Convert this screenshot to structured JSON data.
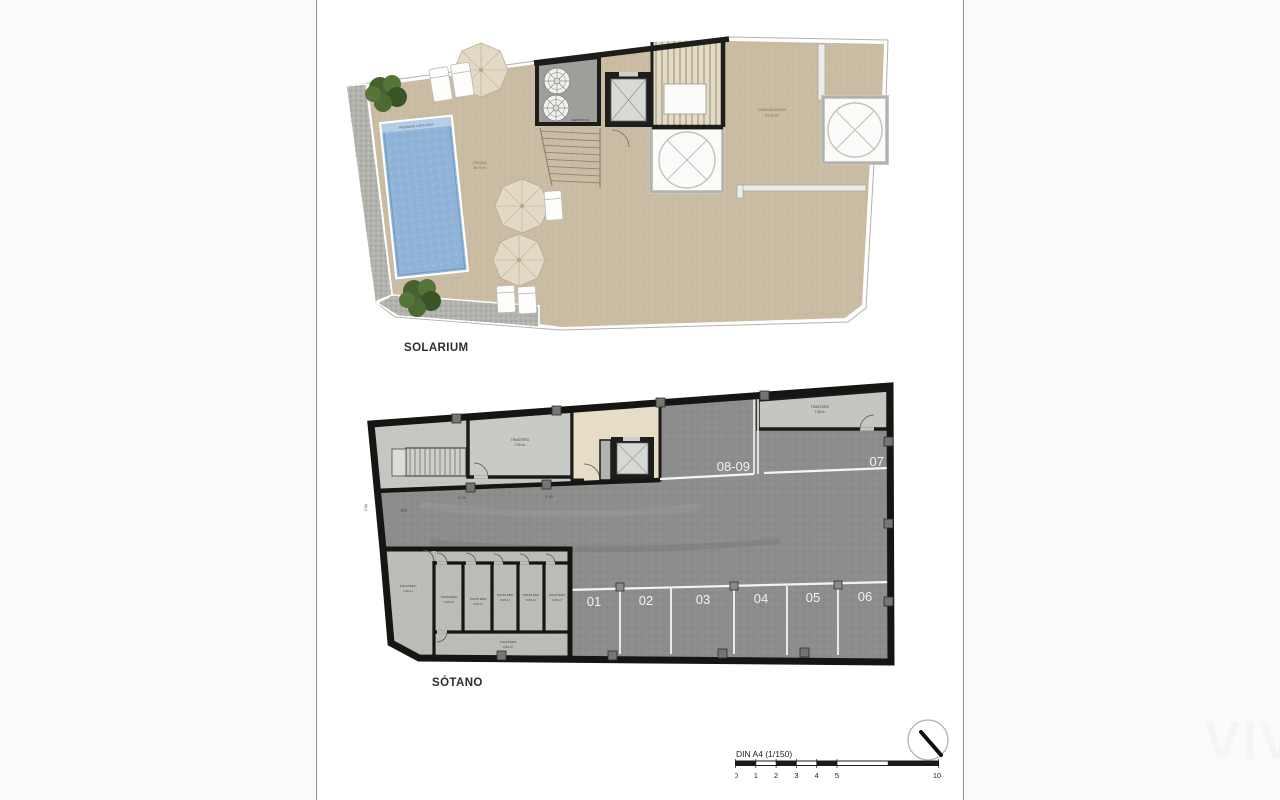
{
  "page": {
    "watermark": "VIV"
  },
  "plans": {
    "solarium": {
      "title": "SOLARIUM",
      "pool_band": "PISCINA DE 1.20 A 2.20 m",
      "pool_name": "PISCINA",
      "pool_area": "60.00 m²",
      "access_name": "ZONA ACCESOS",
      "access_area": "81.00 m²",
      "tanks": "DEPÓSITOS"
    },
    "sotano": {
      "title": "SÓTANO",
      "parking": {
        "p1": "01",
        "p2": "02",
        "p3": "03",
        "p4": "04",
        "p5": "05",
        "p6": "06",
        "p7": "07",
        "p89": "08-09"
      },
      "rooms": {
        "t750": {
          "name": "TRASTERO",
          "area": "7.50 m²"
        },
        "t736": {
          "name": "TRASTERO",
          "area": "7.36 m²"
        },
        "t730": {
          "name": "TRASTERO",
          "area": "7.30 m²"
        },
        "t349": {
          "name": "TRASTERO",
          "area": "3.49 m²"
        },
        "t339": {
          "name": "TRASTERO",
          "area": "3.39 m²"
        },
        "t308a": {
          "name": "TRASTERO",
          "area": "3.08 m²"
        },
        "t308b": {
          "name": "TRASTERO",
          "area": "3.08 m²"
        },
        "t308c": {
          "name": "TRASTERO",
          "area": "3.08 m²"
        },
        "t450": {
          "name": "TRASTERO",
          "area": "4.50 m²"
        }
      },
      "dims": {
        "d420": "4.20",
        "d490": "4.90",
        "d300": "3.00",
        "slope": "5%"
      }
    }
  },
  "scalebar": {
    "title": "DIN A4 (1/150)",
    "t0": "0",
    "t1": "1",
    "t2": "2",
    "t3": "3",
    "t4": "4",
    "t5": "5",
    "t10": "10"
  }
}
